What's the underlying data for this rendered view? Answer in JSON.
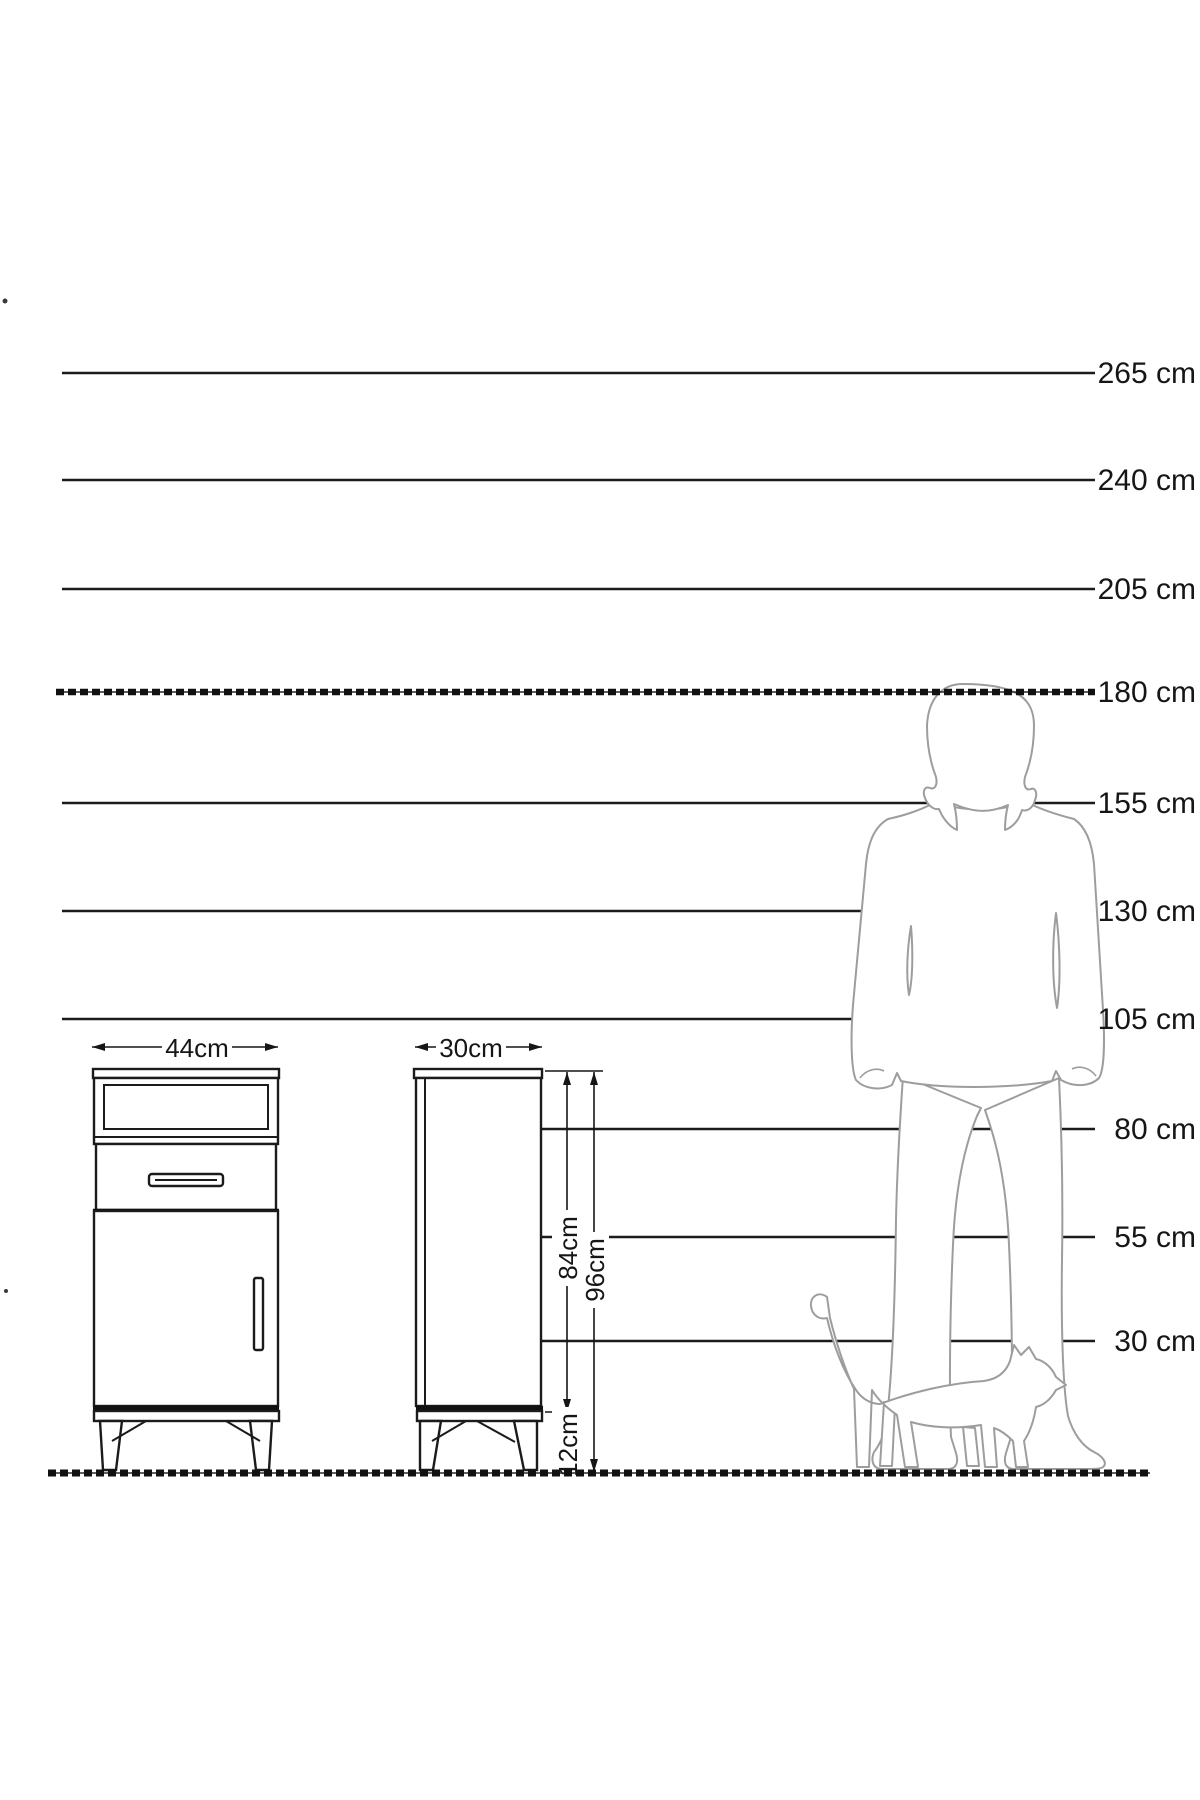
{
  "scale_lines": [
    {
      "label": "265 cm",
      "cm": 265
    },
    {
      "label": "240 cm",
      "cm": 240
    },
    {
      "label": "205 cm",
      "cm": 205
    },
    {
      "label": "180 cm",
      "cm": 180
    },
    {
      "label": "155 cm",
      "cm": 155
    },
    {
      "label": "130 cm",
      "cm": 130
    },
    {
      "label": "105 cm",
      "cm": 105
    },
    {
      "label": "80 cm",
      "cm": 80
    },
    {
      "label": "55 cm",
      "cm": 55
    },
    {
      "label": "30 cm",
      "cm": 30
    }
  ],
  "dimension_labels": {
    "front_width": "44cm",
    "side_depth": "30cm",
    "cabinet_body_height": "84cm",
    "total_height": "96cm",
    "leg_height": "12cm"
  },
  "figures": {
    "man": "adult-man-silhouette",
    "cat": "cat-silhouette"
  },
  "colors": {
    "line": "#161616",
    "figure_outline": "#9d9d9d",
    "background": "#ffffff"
  }
}
